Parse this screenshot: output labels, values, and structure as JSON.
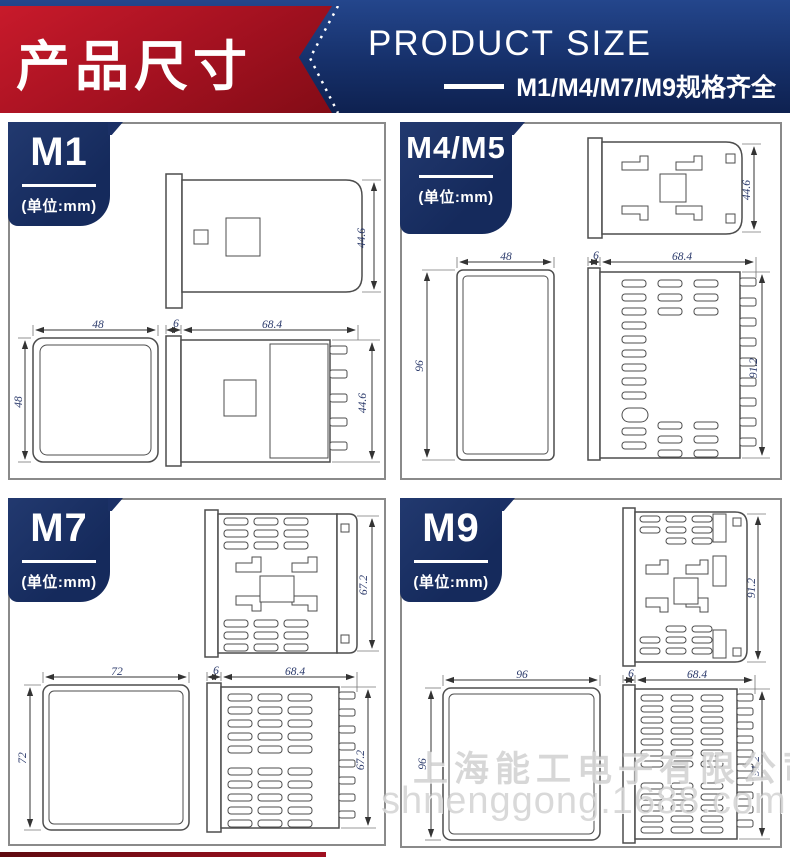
{
  "header": {
    "title_cn": "产品尺寸",
    "title_en": "PRODUCT SIZE",
    "subtitle": "M1/M4/M7/M9规格齐全",
    "colors": {
      "red": "#a31120",
      "navy": "#16306a"
    }
  },
  "panels": [
    {
      "label": "M1",
      "unit": "(单位:mm)",
      "dims": {
        "top_h": "44.6",
        "front_w": "48",
        "front_h": "48",
        "bezel": "6",
        "depth": "68.4",
        "case_h": "44.6"
      }
    },
    {
      "label": "M4/M5",
      "unit": "(单位:mm)",
      "dims": {
        "top_h": "44.6",
        "front_w": "48",
        "front_h": "96",
        "bezel": "6",
        "depth": "68.4",
        "case_h": "91.2"
      }
    },
    {
      "label": "M7",
      "unit": "(单位:mm)",
      "dims": {
        "top_h": "67.2",
        "front_w": "72",
        "front_h": "72",
        "bezel": "6",
        "depth": "68.4",
        "case_h": "67.2"
      }
    },
    {
      "label": "M9",
      "unit": "(单位:mm)",
      "dims": {
        "top_h": "91.2",
        "front_w": "96",
        "front_h": "96",
        "bezel": "6",
        "depth": "68.4",
        "case_h": "91.2"
      }
    }
  ],
  "watermark": {
    "company": "上海能工电子有限公司",
    "url": "shnenggong.1688.com"
  }
}
